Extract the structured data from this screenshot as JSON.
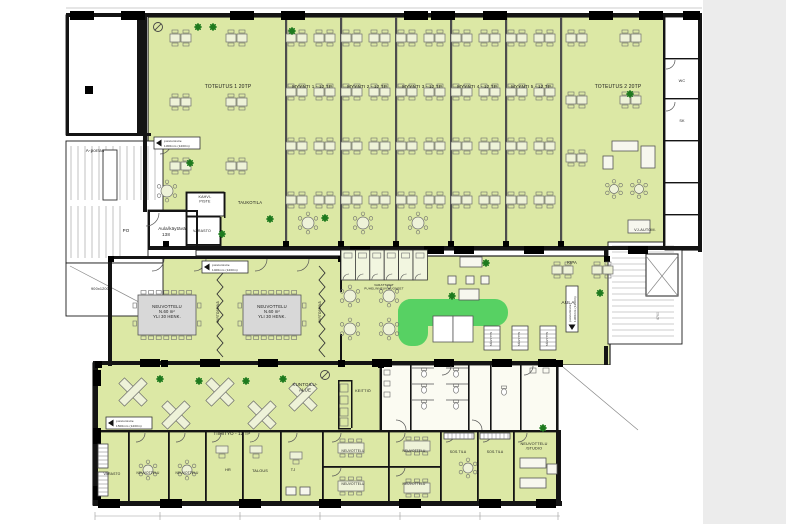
{
  "canvas": {
    "w": 786,
    "h": 524
  },
  "colors": {
    "zone_green": "#dce8a5",
    "zone_border": "#1f1f1f",
    "highlight_green": "#57d163",
    "plant_green": "#1e7a1e",
    "wall": "#141414",
    "gray_wall": "#4d4d4d",
    "desk": "#eef2d8",
    "margin": "#ececec",
    "label": "#1a1a1a",
    "furniture_line": "#6e6e6e"
  },
  "regions": [
    {
      "n": "open-office-north",
      "x": 148,
      "y": 17,
      "w": 552,
      "h": 233
    },
    {
      "n": "meeting-aula-band",
      "x": 110,
      "y": 256,
      "w": 500,
      "h": 109
    },
    {
      "n": "teamwork-south-band",
      "x": 93,
      "y": 363,
      "w": 465,
      "h": 142
    }
  ],
  "white_boxes": [
    [
      66,
      15,
      82,
      120
    ],
    [
      66,
      141,
      97,
      122
    ],
    [
      66,
      263,
      97,
      53
    ],
    [
      148,
      210,
      48,
      48
    ],
    [
      608,
      242,
      74,
      102
    ],
    [
      665,
      17,
      35,
      233
    ],
    [
      380,
      365,
      178,
      66
    ],
    [
      186,
      192,
      38,
      24
    ],
    [
      186,
      216,
      34,
      30
    ],
    [
      560,
      365,
      140,
      143
    ]
  ],
  "highlight": {
    "rects": [
      [
        398,
        299,
        110,
        27,
        13
      ],
      [
        398,
        299,
        30,
        47,
        13
      ]
    ],
    "desks": [
      [
        433,
        316,
        20,
        26
      ],
      [
        453,
        316,
        20,
        26
      ]
    ]
  },
  "label_boxes": [
    [
      149,
      301,
      38,
      19
    ],
    [
      254,
      301,
      38,
      19
    ]
  ],
  "stairs": [
    {
      "x": 71,
      "y": 146,
      "w": 86,
      "h": 54,
      "step": 7,
      "dir": "v"
    },
    {
      "x": 71,
      "y": 206,
      "w": 50,
      "h": 52,
      "step": 7,
      "dir": "v"
    },
    {
      "x": 612,
      "y": 246,
      "w": 62,
      "h": 44,
      "step": 6,
      "dir": "h"
    },
    {
      "x": 612,
      "y": 294,
      "w": 62,
      "h": 46,
      "step": 6,
      "dir": "h"
    }
  ],
  "stair_rails": [
    [
      103,
      150,
      14,
      50
    ]
  ],
  "elevator": [
    646,
    254,
    32,
    42
  ],
  "diagonals": [
    [
      70,
      266,
      158,
      312
    ],
    [
      646,
      256,
      678,
      296
    ],
    [
      678,
      256,
      646,
      296
    ],
    [
      563,
      367,
      638,
      430
    ]
  ],
  "gray_walls": [
    [
      285,
      17,
      2.2,
      229
    ],
    [
      340,
      17,
      2.2,
      229
    ],
    [
      395,
      17,
      2.2,
      229
    ],
    [
      450,
      17,
      2.2,
      229
    ],
    [
      505,
      17,
      2.2,
      229
    ],
    [
      560,
      17,
      2.2,
      229
    ]
  ],
  "walls": [
    [
      66,
      13,
      636,
      4
    ],
    [
      66,
      13,
      3,
      122
    ],
    [
      66,
      133,
      85,
      3
    ],
    [
      137,
      15,
      10,
      118
    ],
    [
      143,
      133,
      4,
      79
    ],
    [
      148,
      246,
      554,
      4
    ],
    [
      110,
      256,
      232,
      3
    ],
    [
      108,
      256,
      4,
      110
    ],
    [
      93,
      361,
      469,
      4
    ],
    [
      93,
      361,
      5,
      145
    ],
    [
      93,
      501,
      469,
      5
    ],
    [
      556,
      430,
      5,
      76
    ],
    [
      698,
      13,
      4,
      239
    ],
    [
      663,
      17,
      2,
      233
    ],
    [
      340,
      250,
      2,
      42
    ],
    [
      340,
      334,
      2,
      32
    ],
    [
      410,
      365,
      1.6,
      66
    ],
    [
      468,
      365,
      1.6,
      66
    ],
    [
      490,
      365,
      1.6,
      66
    ],
    [
      520,
      365,
      1.6,
      66
    ],
    [
      95,
      430,
      463,
      2.4
    ],
    [
      128,
      432,
      1.8,
      70
    ],
    [
      168,
      432,
      1.8,
      70
    ],
    [
      205,
      432,
      1.8,
      70
    ],
    [
      242,
      432,
      1.8,
      70
    ],
    [
      280,
      432,
      1.8,
      70
    ],
    [
      322,
      432,
      1.8,
      70
    ],
    [
      388,
      432,
      1.8,
      70
    ],
    [
      440,
      432,
      1.8,
      70
    ],
    [
      477,
      432,
      1.8,
      70
    ],
    [
      513,
      432,
      1.8,
      70
    ],
    [
      322,
      466,
      118,
      1.8
    ],
    [
      663,
      58,
      37,
      1.4
    ],
    [
      663,
      98,
      37,
      1.4
    ],
    [
      663,
      140,
      37,
      1.4
    ],
    [
      663,
      182,
      37,
      1.4
    ],
    [
      663,
      214,
      37,
      1.4
    ],
    [
      604,
      346,
      4,
      19
    ],
    [
      604,
      248,
      4,
      10
    ],
    [
      380,
      365,
      2,
      66
    ],
    [
      556,
      363,
      2,
      67
    ],
    [
      148,
      210,
      2,
      38
    ],
    [
      148,
      210,
      48,
      2
    ],
    [
      196,
      210,
      2,
      38
    ],
    [
      186,
      192,
      38,
      1.5
    ],
    [
      186,
      192,
      1.5,
      54
    ],
    [
      224,
      192,
      1.5,
      26
    ],
    [
      186,
      216,
      34,
      1.5
    ],
    [
      220,
      217,
      1.5,
      29
    ],
    [
      186,
      244,
      34,
      1.5
    ],
    [
      338,
      380,
      13,
      1.5
    ],
    [
      338,
      380,
      1.5,
      48
    ],
    [
      351,
      380,
      1.5,
      48
    ],
    [
      338,
      428,
      13,
      1.5
    ]
  ],
  "piers": [
    [
      70,
      11,
      24,
      9
    ],
    [
      121,
      11,
      24,
      9
    ],
    [
      230,
      11,
      24,
      9
    ],
    [
      281,
      11,
      24,
      9
    ],
    [
      404,
      11,
      24,
      9
    ],
    [
      431,
      11,
      24,
      9
    ],
    [
      483,
      11,
      24,
      9
    ],
    [
      589,
      11,
      24,
      9
    ],
    [
      639,
      11,
      24,
      9
    ],
    [
      683,
      11,
      17,
      9
    ],
    [
      350,
      246,
      20,
      8
    ],
    [
      424,
      246,
      20,
      8
    ],
    [
      454,
      246,
      20,
      8
    ],
    [
      524,
      246,
      20,
      8
    ],
    [
      628,
      246,
      20,
      8
    ],
    [
      140,
      359,
      20,
      8
    ],
    [
      200,
      359,
      20,
      8
    ],
    [
      258,
      359,
      20,
      8
    ],
    [
      372,
      359,
      20,
      8
    ],
    [
      434,
      359,
      20,
      8
    ],
    [
      492,
      359,
      20,
      8
    ],
    [
      538,
      359,
      18,
      8
    ],
    [
      98,
      499,
      22,
      9
    ],
    [
      160,
      499,
      22,
      9
    ],
    [
      239,
      499,
      22,
      9
    ],
    [
      319,
      499,
      22,
      9
    ],
    [
      399,
      499,
      22,
      9
    ],
    [
      479,
      499,
      22,
      9
    ],
    [
      536,
      499,
      20,
      9
    ],
    [
      93,
      370,
      8,
      16
    ],
    [
      93,
      428,
      8,
      16
    ],
    [
      93,
      486,
      8,
      14
    ]
  ],
  "columns": [
    [
      85,
      86,
      8,
      8
    ],
    [
      283,
      241,
      6,
      6
    ],
    [
      338,
      241,
      6,
      6
    ],
    [
      393,
      241,
      6,
      6
    ],
    [
      448,
      241,
      6,
      6
    ],
    [
      503,
      241,
      6,
      6
    ],
    [
      558,
      241,
      6,
      6
    ],
    [
      163,
      241,
      6,
      6
    ],
    [
      161,
      360,
      7,
      7
    ],
    [
      338,
      360,
      7,
      7
    ],
    [
      556,
      360,
      7,
      7
    ],
    [
      95,
      361,
      7,
      7
    ],
    [
      108,
      256,
      6,
      6
    ],
    [
      338,
      256,
      6,
      6
    ],
    [
      604,
      256,
      6,
      6
    ],
    [
      378,
      362,
      6,
      6
    ]
  ],
  "zigzags": [
    {
      "x": 220,
      "y1": 266,
      "y2": 360
    },
    {
      "x": 322,
      "y1": 266,
      "y2": 360
    }
  ],
  "arcs": [
    [
      152,
      259,
      12,
      0
    ],
    [
      194,
      259,
      12,
      0
    ],
    [
      255,
      259,
      12,
      0
    ],
    [
      297,
      259,
      12,
      0
    ],
    [
      146,
      213,
      13,
      0
    ],
    [
      160,
      143,
      11,
      0
    ],
    [
      666,
      60,
      9,
      0
    ],
    [
      666,
      102,
      9,
      0
    ],
    [
      396,
      430,
      10,
      3
    ],
    [
      472,
      430,
      10,
      3
    ],
    [
      442,
      366,
      9,
      0
    ],
    [
      524,
      366,
      9,
      0
    ],
    [
      136,
      433,
      9,
      0
    ],
    [
      176,
      433,
      9,
      0
    ],
    [
      212,
      433,
      9,
      0
    ],
    [
      250,
      433,
      9,
      0
    ],
    [
      288,
      433,
      9,
      0
    ],
    [
      332,
      433,
      9,
      0
    ],
    [
      396,
      433,
      9,
      0
    ],
    [
      446,
      433,
      9,
      0
    ],
    [
      483,
      433,
      9,
      0
    ],
    [
      518,
      433,
      9,
      0
    ],
    [
      332,
      467,
      9,
      0
    ],
    [
      396,
      467,
      9,
      0
    ]
  ],
  "desk_grids": [
    {
      "x": 170,
      "y": 30,
      "cols": 2,
      "rows": 3,
      "dx": 56,
      "dy": 64
    },
    {
      "x": 286,
      "y": 30,
      "cols": 2,
      "rows": 4,
      "dx": 28,
      "dy": 54
    },
    {
      "x": 341,
      "y": 30,
      "cols": 2,
      "rows": 4,
      "dx": 28,
      "dy": 54
    },
    {
      "x": 396,
      "y": 30,
      "cols": 2,
      "rows": 4,
      "dx": 28,
      "dy": 54
    },
    {
      "x": 451,
      "y": 30,
      "cols": 2,
      "rows": 4,
      "dx": 28,
      "dy": 54
    },
    {
      "x": 506,
      "y": 30,
      "cols": 2,
      "rows": 4,
      "dx": 28,
      "dy": 54
    },
    {
      "x": 566,
      "y": 30,
      "cols": 2,
      "rows": 2,
      "dx": 54,
      "dy": 62
    },
    {
      "x": 566,
      "y": 150,
      "cols": 1,
      "rows": 1,
      "dx": 0,
      "dy": 0
    },
    {
      "x": 552,
      "y": 262,
      "cols": 2,
      "rows": 1,
      "dx": 40,
      "dy": 0
    }
  ],
  "single_desks": [
    [
      216,
      446
    ],
    [
      250,
      446
    ],
    [
      290,
      452
    ]
  ],
  "x_clusters": [
    [
      133,
      392
    ],
    [
      176,
      415
    ],
    [
      220,
      392
    ],
    [
      262,
      415
    ],
    [
      303,
      397
    ]
  ],
  "round_tables": [
    [
      167,
      191,
      6
    ],
    [
      308,
      223,
      6
    ],
    [
      363,
      223,
      6
    ],
    [
      418,
      223,
      6
    ],
    [
      350,
      296,
      6
    ],
    [
      389,
      296,
      6
    ],
    [
      350,
      329,
      6
    ],
    [
      389,
      329,
      6
    ],
    [
      148,
      470,
      5
    ],
    [
      187,
      470,
      5
    ],
    [
      468,
      468,
      5
    ],
    [
      614,
      189,
      4.5
    ],
    [
      639,
      189,
      4.5
    ]
  ],
  "conference_tables": [
    [
      138,
      295,
      58,
      40
    ],
    [
      243,
      295,
      58,
      40
    ]
  ],
  "small_tables": [
    [
      338,
      443,
      26,
      10
    ],
    [
      404,
      441,
      26,
      10
    ],
    [
      338,
      481,
      26,
      10
    ],
    [
      404,
      483,
      26,
      10
    ]
  ],
  "phone_booths": {
    "x": 341,
    "y": 250,
    "n": 6,
    "w": 14.4,
    "h": 30
  },
  "lockers": [
    [
      484,
      326,
      16,
      24
    ],
    [
      512,
      326,
      16,
      24
    ],
    [
      540,
      326,
      16,
      24
    ],
    [
      444,
      433,
      30,
      6
    ],
    [
      480,
      433,
      30,
      6
    ],
    [
      98,
      444,
      10,
      24
    ],
    [
      98,
      472,
      10,
      24
    ]
  ],
  "sofa_rects": [
    [
      460,
      257,
      22,
      10
    ],
    [
      448,
      276,
      8,
      8
    ],
    [
      466,
      276,
      8,
      8
    ],
    [
      481,
      276,
      8,
      8
    ],
    [
      459,
      289,
      20,
      11
    ],
    [
      612,
      141,
      26,
      10
    ],
    [
      603,
      156,
      10,
      13
    ],
    [
      641,
      146,
      14,
      22
    ],
    [
      520,
      458,
      26,
      10
    ],
    [
      520,
      478,
      26,
      10
    ],
    [
      547,
      464,
      10,
      10
    ],
    [
      286,
      487,
      10,
      8
    ],
    [
      300,
      487,
      10,
      8
    ],
    [
      628,
      220,
      22,
      13
    ]
  ],
  "wc": {
    "toilets": [
      [
        424,
        374
      ],
      [
        424,
        390
      ],
      [
        424,
        406
      ],
      [
        456,
        374
      ],
      [
        456,
        390
      ],
      [
        456,
        406
      ],
      [
        504,
        392
      ]
    ],
    "sinks": [
      [
        384,
        370
      ],
      [
        384,
        381
      ],
      [
        384,
        392
      ],
      [
        530,
        368
      ],
      [
        543,
        368
      ]
    ],
    "stalls": [
      [
        412,
        368,
        434,
        368
      ],
      [
        412,
        384,
        434,
        384
      ],
      [
        412,
        400,
        434,
        400
      ],
      [
        446,
        368,
        468,
        368
      ],
      [
        446,
        384,
        468,
        384
      ],
      [
        446,
        400,
        468,
        400
      ]
    ]
  },
  "kitchen_squares": [
    [
      340,
      384
    ],
    [
      340,
      396
    ],
    [
      340,
      408
    ],
    [
      340,
      418
    ]
  ],
  "plants": [
    [
      198,
      27
    ],
    [
      213,
      27
    ],
    [
      292,
      31
    ],
    [
      630,
      94
    ],
    [
      190,
      163
    ],
    [
      222,
      234
    ],
    [
      270,
      219
    ],
    [
      325,
      218
    ],
    [
      486,
      263
    ],
    [
      452,
      296
    ],
    [
      600,
      293
    ],
    [
      160,
      379
    ],
    [
      199,
      381
    ],
    [
      246,
      381
    ],
    [
      283,
      379
    ],
    [
      543,
      428
    ]
  ],
  "no_symbols": [
    [
      158,
      27
    ],
    [
      325,
      375
    ]
  ],
  "dimensions": {
    "lines": [
      [
        66,
        8,
        702,
        8
      ],
      [
        95,
        516,
        560,
        516
      ]
    ],
    "ticks": [
      95,
      160,
      240,
      320,
      400,
      480,
      558
    ]
  },
  "exit_signs": [
    {
      "t1": "poistumistie",
      "t2": "1300mm (1200m)",
      "x": 154,
      "y": 137,
      "rot": 0
    },
    {
      "t1": "poistumistie",
      "t2": "1400mm (1200m)",
      "x": 202,
      "y": 261,
      "rot": 0
    },
    {
      "t1": "poistumistie",
      "t2": "1500mm (1200m)",
      "x": 106,
      "y": 417,
      "rot": 0
    },
    {
      "t1": "poistumistie",
      "t2": "1300mm (1200m)",
      "x": 566,
      "y": 332,
      "rot": -90
    }
  ],
  "labels": [
    {
      "t": "TOTEUTUS 1   20TP",
      "x": 228,
      "y": 88,
      "fs": 5
    },
    {
      "t": "MYYNTI 1 - 12 TP",
      "x": 312,
      "y": 88,
      "fs": 4.6
    },
    {
      "t": "MYYNTI 2 - 12 TP",
      "x": 367,
      "y": 88,
      "fs": 4.6
    },
    {
      "t": "MYYNTI 3 - 12 TP",
      "x": 422,
      "y": 88,
      "fs": 4.6
    },
    {
      "t": "MYYNTI 4 - 12 TP",
      "x": 477,
      "y": 88,
      "fs": 4.6
    },
    {
      "t": "MYYNTI 5 - 12 TP",
      "x": 531,
      "y": 88,
      "fs": 4.6
    },
    {
      "t": "TOTEUTUS 2   20TP",
      "x": 618,
      "y": 88,
      "fs": 5
    },
    {
      "t": "A-porras",
      "x": 95,
      "y": 152,
      "fs": 4.5
    },
    {
      "t": "Aula/käytävä",
      "x": 172,
      "y": 230,
      "fs": 4.5
    },
    {
      "t": "138",
      "x": 166,
      "y": 236,
      "fs": 4.5
    },
    {
      "t": "PO",
      "x": 126,
      "y": 232,
      "fs": 4.5
    },
    {
      "t": "KAHVI-\nPISTE",
      "x": 205,
      "y": 198,
      "fs": 3.6
    },
    {
      "t": "VARASTO",
      "x": 202,
      "y": 232,
      "fs": 3.6
    },
    {
      "t": "TAUKOTILA",
      "x": 250,
      "y": 204,
      "fs": 4.2
    },
    {
      "t": "NEUVOTTELU\nN.60 m²\nYLI 30 HENK.",
      "x": 167,
      "y": 308,
      "fs": 4.2
    },
    {
      "t": "NEUVOTTELU\nN.60 m²\nYLI 30 HENK.",
      "x": 272,
      "y": 308,
      "fs": 4.2
    },
    {
      "t": "SIIRTOSEINÄ",
      "x": 219,
      "y": 312,
      "fs": 3.2,
      "rot": -90
    },
    {
      "t": "SIIRTOSEINÄ",
      "x": 321,
      "y": 312,
      "fs": 3.2,
      "rot": -90
    },
    {
      "t": "VARATTAVAT\nPUHELINNEUV.HUONEET",
      "x": 384,
      "y": 286,
      "fs": 3
    },
    {
      "t": "KIPA",
      "x": 572,
      "y": 264,
      "fs": 4.2
    },
    {
      "t": "AULA",
      "x": 568,
      "y": 304,
      "fs": 4.8
    },
    {
      "t": "VJ-AUTOM.",
      "x": 645,
      "y": 231,
      "fs": 3.8
    },
    {
      "t": "WC",
      "x": 682,
      "y": 82,
      "fs": 3.8
    },
    {
      "t": "SK",
      "x": 682,
      "y": 122,
      "fs": 3.8
    },
    {
      "t": "TIIMITYÖ - 12 TP",
      "x": 232,
      "y": 435,
      "fs": 4.4
    },
    {
      "t": "KUNTOILU-\nALUE",
      "x": 305,
      "y": 386,
      "fs": 4.4
    },
    {
      "t": "KEITTIÖ",
      "x": 363,
      "y": 392,
      "fs": 3.8
    },
    {
      "t": "VARASTO",
      "x": 112,
      "y": 475,
      "fs": 3.4
    },
    {
      "t": "NEUVOTTELU",
      "x": 148,
      "y": 474,
      "fs": 3.2
    },
    {
      "t": "NEUVOTTELU",
      "x": 187,
      "y": 474,
      "fs": 3.2
    },
    {
      "t": "HR",
      "x": 228,
      "y": 471,
      "fs": 3.8
    },
    {
      "t": "TALOUS",
      "x": 260,
      "y": 472,
      "fs": 3.8
    },
    {
      "t": "TJ",
      "x": 293,
      "y": 471,
      "fs": 3.8
    },
    {
      "t": "NEUVOTTELU",
      "x": 353,
      "y": 452,
      "fs": 3.2
    },
    {
      "t": "NEUVOTTELU",
      "x": 414,
      "y": 452,
      "fs": 3.2
    },
    {
      "t": "NEUVOTTELU",
      "x": 353,
      "y": 485,
      "fs": 3.2
    },
    {
      "t": "NEUVOTTELU",
      "x": 414,
      "y": 485,
      "fs": 3.2
    },
    {
      "t": "SOS.TILA",
      "x": 458,
      "y": 453,
      "fs": 3.4
    },
    {
      "t": "SOS.TILA",
      "x": 495,
      "y": 453,
      "fs": 3.4
    },
    {
      "t": "NEUVOTTELU\n/STUDIO",
      "x": 534,
      "y": 445,
      "fs": 3.8
    },
    {
      "t": "900x1200",
      "x": 100,
      "y": 290,
      "fs": 3.8
    },
    {
      "t": "SÄILYTYS",
      "x": 492,
      "y": 339,
      "fs": 2.8,
      "rot": -90
    },
    {
      "t": "SÄILYTYS",
      "x": 520,
      "y": 339,
      "fs": 2.8,
      "rot": -90
    },
    {
      "t": "SÄILYTYS",
      "x": 548,
      "y": 339,
      "fs": 2.8,
      "rot": -90
    },
    {
      "t": "4760",
      "x": 659,
      "y": 316,
      "fs": 3.4,
      "rot": -90,
      "col": "#777777"
    }
  ]
}
